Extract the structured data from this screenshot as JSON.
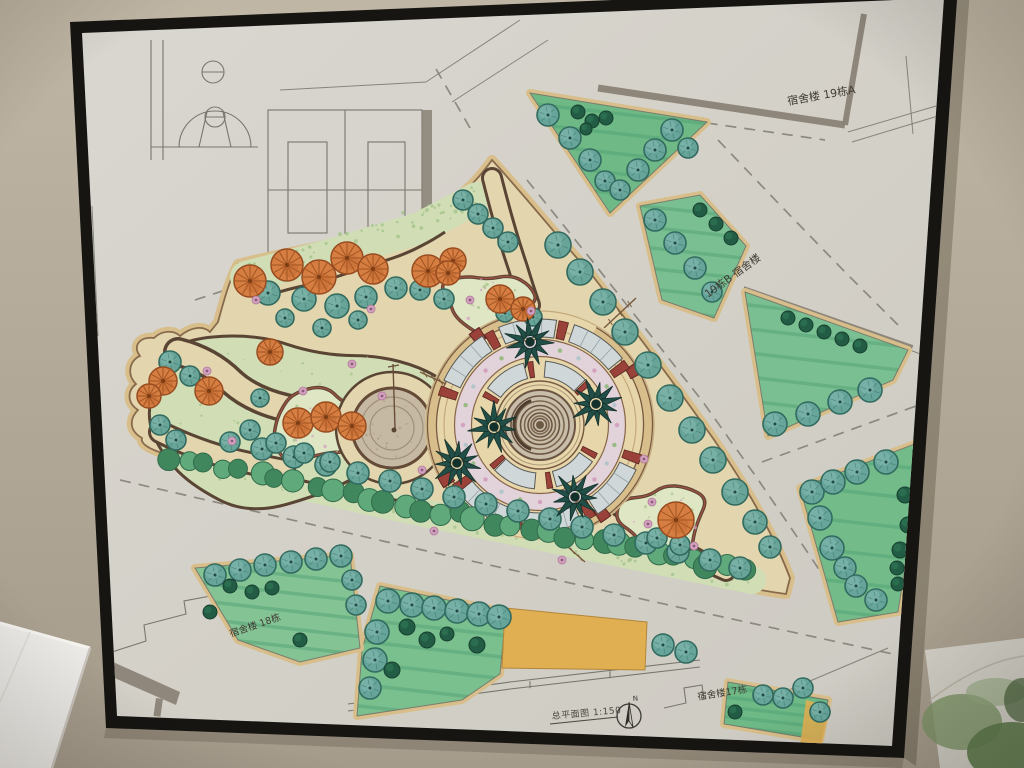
{
  "scene": {
    "type": "photograph",
    "subject": "Hand-drawn landscape master plan mounted in a black frame on a beige wall"
  },
  "drawing": {
    "labels": {
      "dorm_19a": "宿舍楼 19栋A",
      "dorm_19b": "19栋B 宿舍楼",
      "dorm_18": "宿舍楼 18栋",
      "dorm_17": "宿舍楼17栋"
    },
    "title_block": {
      "title_scale": "总平面图 1:150",
      "north_label": "N"
    },
    "features": [
      "central circular fountain plaza with spiral center",
      "palm trees around fountain",
      "curved benches and flower mosaic ring",
      "winding garden paths with round orange trees",
      "pond with fountain pole",
      "triangular park bounded by roads with dashed centerlines",
      "lawn patches with teal trees and dark shrubs",
      "pencil buildings and basketball court at top left"
    ]
  },
  "palette": {
    "wall": "#bdb3a2",
    "wall_dark": "#a4998a",
    "frame": "#161512",
    "paper": "#dfdcd6",
    "paper_dark": "#d3d0c8",
    "park_ground": "#ebdeb4",
    "plaza_ground": "#eeddb0",
    "park_border_tan": "#e0c48e",
    "bed_light_green": "#d7e5bb",
    "cloud_green": "#e6eecb",
    "bed_stipple": "#a9c98e",
    "lawn_green": "#7cc292",
    "lawn_streak": "#4da273",
    "tree_teal": "#6aa89e",
    "tree_teal_dark": "#2f6b60",
    "tree_teal_light": "#93c9bd",
    "bush_dark": "#1e5c43",
    "tree_orange": "#dd8040",
    "tree_orange_dark": "#9c4a1d",
    "palm_green": "#1d4d46",
    "path_brown": "#5a4232",
    "accent_red": "#9e4038",
    "bench_gray": "#d6dfe2",
    "mosaic_pink": "#d9a6c6",
    "pond_gray": "#cdbfa8",
    "marker_gray": "#8b8276",
    "pencil": "#7b786f",
    "yellow_area": "#e7b452",
    "ink": "#3f3b33"
  }
}
